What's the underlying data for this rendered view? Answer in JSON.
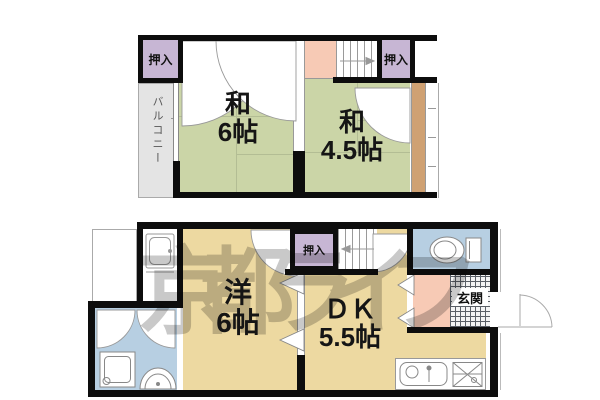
{
  "watermark": {
    "text": "京都ライフ"
  },
  "colors": {
    "wall_black": "#0d0d0d",
    "tatami_green": "#cbd5a7",
    "room_tan": "#edd9a1",
    "closet_purple": "#c7b6d4",
    "landing_pink": "#f7cab5",
    "water_blue": "#b7cfe2",
    "balcony_gray": "#e4e4e4",
    "corridor_brown": "#cfa173",
    "watermark_gray": "#c9c9c9"
  },
  "upper_floor": {
    "closet_left_label": "押入",
    "closet_right_label": "押入",
    "balcony_label": "バルコニー",
    "japanese_room_6": {
      "type_label": "和",
      "size_label": "6帖"
    },
    "japanese_room_45": {
      "type_label": "和",
      "size_label": "4.5帖"
    }
  },
  "lower_floor": {
    "closet_label": "押入",
    "entrance_label": "玄関",
    "western_room_6": {
      "type_label": "洋",
      "size_label": "6帖"
    },
    "dining_kitchen": {
      "type_label": "ＤＫ",
      "size_label": "5.5帖"
    }
  }
}
